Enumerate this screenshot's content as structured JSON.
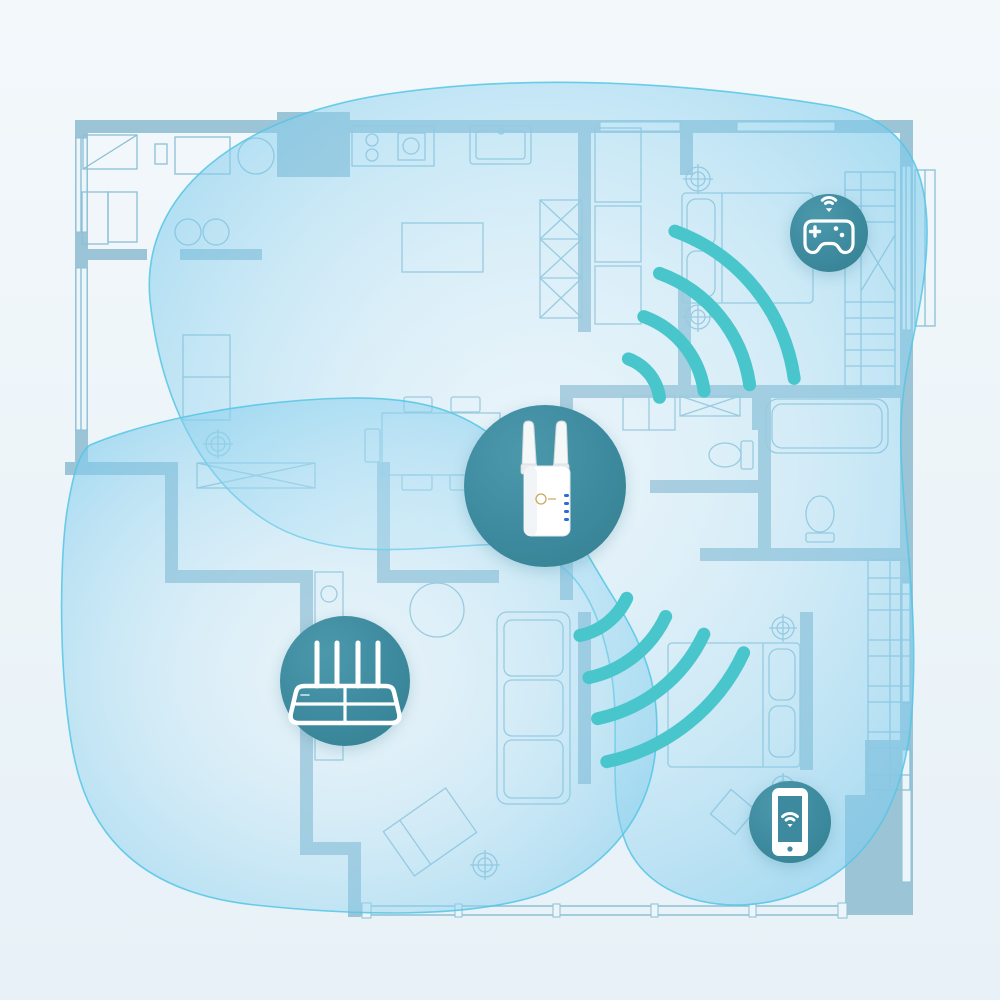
{
  "meta": {
    "description": "Apartment floor-plan illustration showing a Wi-Fi router and a wall-plug range extender, their overlapping wireless coverage areas, and connected devices (game controller, smartphone).",
    "type": "wifi-coverage-diagram",
    "visible_text": []
  },
  "colors": {
    "background_top": "#f3f8fb",
    "background_bottom": "#e7f1f7",
    "wall": "#9cc4d7",
    "furniture_line": "#8cc0d6",
    "coverage_fill": "#bfe5f5",
    "coverage_edge": "#55c5e4",
    "node_fill": "#3d8a9f",
    "signal_arc": "#49c6cc",
    "device_led": "#2e6bd6",
    "device_body": "#ffffff",
    "logo_gold": "#c9a85f"
  },
  "nodes": [
    {
      "id": "extender",
      "icon": "range-extender-device",
      "label": "Wi-Fi range extender",
      "x": 545,
      "y": 486,
      "r": 81
    },
    {
      "id": "router",
      "icon": "router-icon",
      "label": "Wi-Fi router",
      "x": 345,
      "y": 681,
      "r": 65
    },
    {
      "id": "gaming",
      "icon": "game-controller-wifi-icon",
      "label": "Wireless game controller",
      "x": 829,
      "y": 233,
      "r": 39
    },
    {
      "id": "phone",
      "icon": "smartphone-wifi-icon",
      "label": "Smartphone on Wi-Fi",
      "x": 790,
      "y": 822,
      "r": 41
    }
  ],
  "signals": [
    {
      "name": "signal-to-game-room",
      "from": "extender",
      "direction": "northeast",
      "center": {
        "x": 612,
        "y": 404
      },
      "radii": [
        48,
        93,
        139,
        184
      ],
      "start_angle_deg": -70,
      "end_angle_deg": -8
    },
    {
      "name": "signal-to-phone-room",
      "from": "extender",
      "direction": "southeast",
      "center": {
        "x": 566,
        "y": 570
      },
      "radii": [
        67,
        110,
        152,
        196
      ],
      "start_angle_deg": 25,
      "end_angle_deg": 78
    }
  ],
  "coverage_areas": [
    {
      "name": "extender-coverage",
      "source": "extender"
    },
    {
      "name": "router-coverage",
      "source": "router"
    }
  ]
}
